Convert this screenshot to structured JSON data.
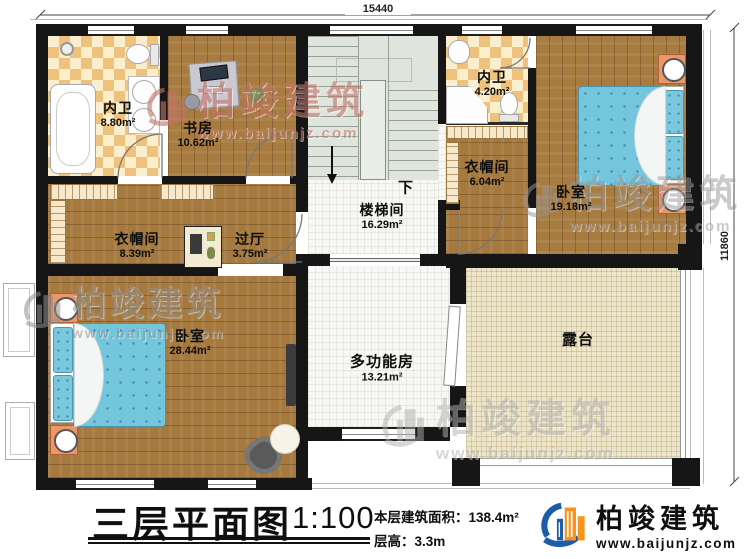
{
  "dimensions": {
    "top": "15440",
    "right": "11860"
  },
  "stairs": {
    "direction_label": "下"
  },
  "rooms": [
    {
      "id": "bath-1",
      "name": "内卫",
      "area": "8.80m²"
    },
    {
      "id": "study",
      "name": "书房",
      "area": "10.62m²"
    },
    {
      "id": "stairwell",
      "name": "楼梯间",
      "area": "16.29m²"
    },
    {
      "id": "bath-2",
      "name": "内卫",
      "area": "4.20m²"
    },
    {
      "id": "cloakroom-2",
      "name": "衣帽间",
      "area": "6.04m²"
    },
    {
      "id": "bedroom-2",
      "name": "卧室",
      "area": "19.18m²"
    },
    {
      "id": "cloakroom-1",
      "name": "衣帽间",
      "area": "8.39m²"
    },
    {
      "id": "hall",
      "name": "过厅",
      "area": "3.75m²"
    },
    {
      "id": "bedroom-1",
      "name": "卧室",
      "area": "28.44m²"
    },
    {
      "id": "multi-room",
      "name": "多功能房",
      "area": "13.21m²"
    },
    {
      "id": "terrace",
      "name": "露台",
      "area": ""
    }
  ],
  "footer": {
    "plan_title": "三层平面图",
    "scale": "1:100",
    "floor_area": "本层建筑面积：138.4m²",
    "floor_height": "层高：3.3m"
  },
  "brand": {
    "name": "柏竣建筑",
    "url": "www.baijunjz.com"
  },
  "colors": {
    "wall": "#161616",
    "wood": "#a6793f",
    "tile_orange": "#eec27c",
    "tile_cream": "#fbeecd",
    "stair": "#dfe4dd",
    "terrace": "#ece5c9",
    "bed_blue": "#74c6dc",
    "nightstand_orange": "#e9976b",
    "logo_blue": "#1c5ca8",
    "logo_orange": "#f7941d"
  }
}
